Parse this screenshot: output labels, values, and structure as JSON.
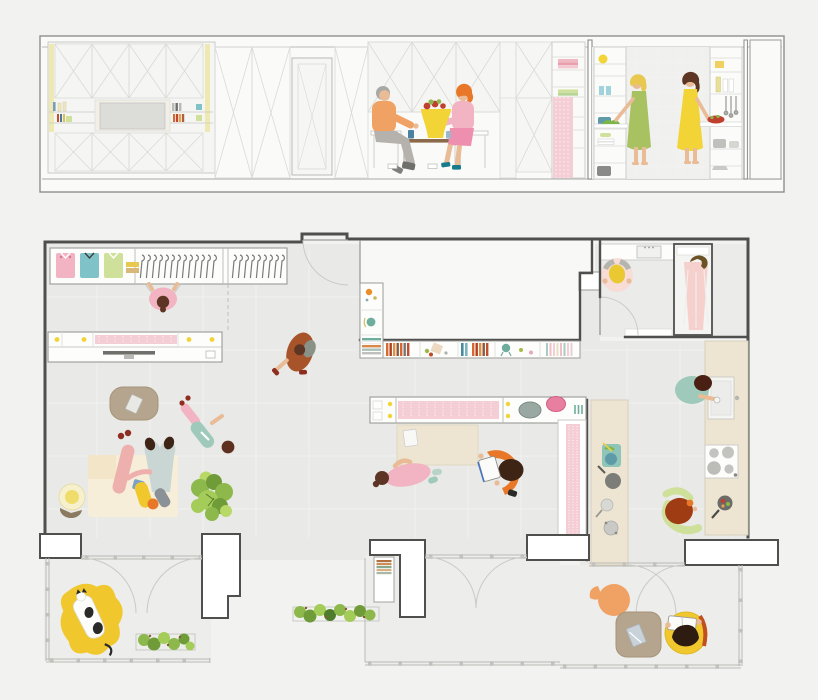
{
  "title": "Architectural drawing of a small apartment: sectional elevation above a furnished floor plan with residents",
  "palette": {
    "bg": "#f2f2f0",
    "paper": "#fafaf9",
    "frame": "#8f8f8c",
    "lineLight": "#dadad7",
    "lineMed": "#b9b9b6",
    "lineSoft": "#c9c9c6",
    "wall": "#4f4f4d",
    "floor": "#e9e9e7",
    "floorBalcony": "#ededeb",
    "grid": "#f3f3f1",
    "voidc": "#f8f8f6",
    "white": "#fdfdfc",
    "beige": "#ede5d1",
    "beigeEdge": "#d8d0bc",
    "cream": "#f7eeda",
    "tan": "#b5a48e",
    "tanEdge": "#a08e74",
    "pinkHatch": "#f5cdd4",
    "pink": "#f2b3c2",
    "pinkDeep": "#ee8fb0",
    "rose": "#eeb0ac",
    "orange": "#efa263",
    "orangeDeep": "#e87828",
    "rust": "#a8542a",
    "redBrown": "#a03c14",
    "red": "#c04030",
    "darkRed": "#8e2e20",
    "yellow": "#f2d437",
    "yellowDeep": "#f0c82e",
    "butter": "#eee9b2",
    "blonde": "#e8c84f",
    "green": "#a9c261",
    "leaf": "#8cb84c",
    "leafDark": "#6f9c38",
    "leafLight": "#b8d868",
    "paleGreen": "#cfe09a",
    "teal": "#9fcabb",
    "tealDeep": "#5f9aa8",
    "cyan": "#7fc3c9",
    "blueGray": "#c9d6d4",
    "blue": "#4a78c0",
    "skin": "#e9bb96",
    "hairBrown": "#5d3524",
    "hairDark": "#3e2414",
    "hairGray": "#a8a8a5",
    "gray": "#b9b9b6",
    "grayDark": "#6f6f6c",
    "steam": "#f8dcd6"
  },
  "section": {
    "name": "cross-section elevation",
    "elements": [
      "media wall with x-braced cabinets and tv",
      "wardrobe panels",
      "interior door",
      "dining nook with fold-down table",
      "tall storage cabinet with towels",
      "pink curtain panel",
      "kitchen shelving with dishes and utensils"
    ],
    "people": [
      {
        "id": "man-dining",
        "pose": "seated at table",
        "top": "orange",
        "bottom": "gray",
        "hair": "gray"
      },
      {
        "id": "woman-dining",
        "pose": "seated at table",
        "top": "pink",
        "bottom": "pink skirt",
        "hair": "orange"
      },
      {
        "id": "woman-kitchen-green",
        "pose": "standing at counter",
        "dress": "green",
        "hair": "blonde"
      },
      {
        "id": "woman-kitchen-yellow",
        "pose": "standing at counter",
        "dress": "yellow",
        "hair": "brown"
      }
    ],
    "props": [
      "fruit bowl on yellow vase",
      "blue cups",
      "pink towels",
      "green towels",
      "lemon",
      "hanging utensils",
      "salad bowl",
      "pots and pans"
    ]
  },
  "plan": {
    "name": "floor plan",
    "rooms": [
      "living area",
      "wardrobe wall",
      "entry",
      "adjacent void",
      "bathroom with shower",
      "kitchen with island",
      "three balconies"
    ],
    "furniture": [
      "wardrobe with folded shirts and hangers",
      "media console with tv",
      "fold-away table console with stools",
      "dining table",
      "coffee table",
      "rug",
      "floor lamp",
      "book shelf wall",
      "kitchen island",
      "sink",
      "four-burner stove",
      "bean bag",
      "outdoor table",
      "hanging chair",
      "planters",
      "potted plant"
    ],
    "people": [
      {
        "id": "person-wardrobe",
        "pose": "reaching into wardrobe",
        "top": "pink",
        "hair": "brown"
      },
      {
        "id": "person-walking",
        "pose": "walking",
        "top": "rust",
        "bag": "olive"
      },
      {
        "id": "family-on-rug",
        "pose": "two adults and child lying on rug",
        "colors": [
          "rose",
          "blue-gray",
          "yellow"
        ]
      },
      {
        "id": "person-lying",
        "pose": "lying on floor",
        "top": "teal",
        "bottom": "pink"
      },
      {
        "id": "person-at-table",
        "pose": "leaning at dining table",
        "top": "pink"
      },
      {
        "id": "person-reading-chair",
        "pose": "reading in orange chair",
        "book": "white"
      },
      {
        "id": "person-at-sink",
        "pose": "washing at kitchen sink",
        "top": "teal"
      },
      {
        "id": "person-cooking",
        "pose": "cooking at counter",
        "apron": "red-brown",
        "sleeves": "pale green"
      },
      {
        "id": "person-vanity",
        "pose": "at bathroom mirror",
        "towel": "yellow"
      },
      {
        "id": "person-shower",
        "pose": "showering",
        "hair": "dark olive"
      },
      {
        "id": "person-hanging-chair",
        "pose": "reading in yellow chair on balcony"
      },
      {
        "id": "cat",
        "pose": "lying on yellow bean bag",
        "colors": [
          "white",
          "black"
        ]
      }
    ]
  }
}
